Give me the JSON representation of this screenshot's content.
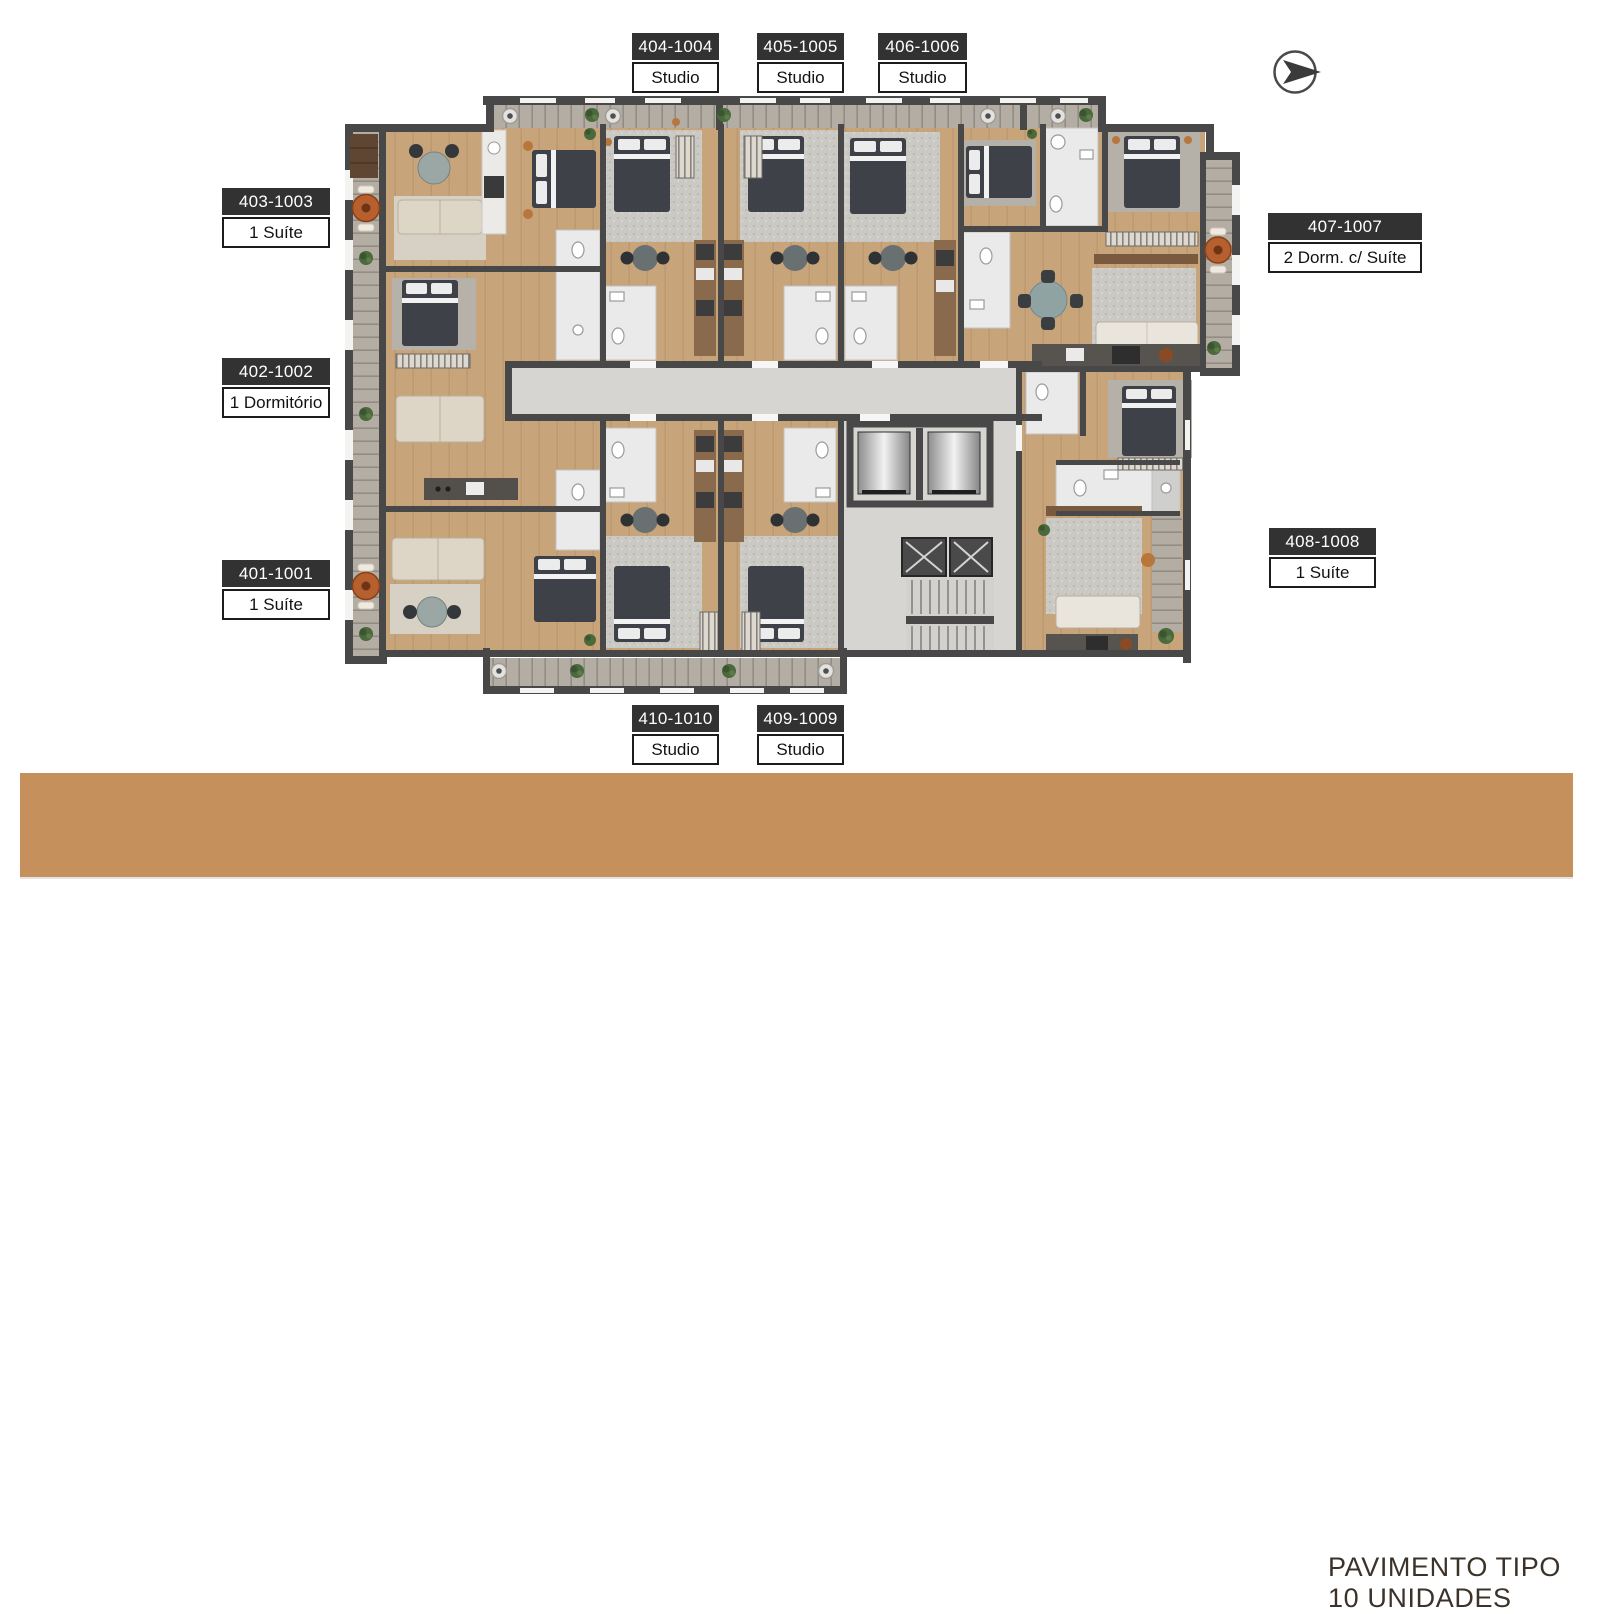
{
  "units": [
    {
      "id": "401-1001",
      "type": "1 Suíte",
      "side": "left"
    },
    {
      "id": "402-1002",
      "type": "1 Dormitório",
      "side": "left"
    },
    {
      "id": "403-1003",
      "type": "1 Suíte",
      "side": "left"
    },
    {
      "id": "404-1004",
      "type": "Studio",
      "side": "top"
    },
    {
      "id": "405-1005",
      "type": "Studio",
      "side": "top"
    },
    {
      "id": "406-1006",
      "type": "Studio",
      "side": "top"
    },
    {
      "id": "407-1007",
      "type": "2 Dorm. c/ Suíte",
      "side": "right"
    },
    {
      "id": "408-1008",
      "type": "1 Suíte",
      "side": "right"
    },
    {
      "id": "409-1009",
      "type": "Studio",
      "side": "bottom"
    },
    {
      "id": "410-1010",
      "type": "Studio",
      "side": "bottom"
    }
  ],
  "footer": {
    "line1": "PAVIMENTO TIPO",
    "line2": "10 UNIDADES"
  },
  "icons": {
    "north_arrow": "north-arrow"
  },
  "palette": {
    "footer_bar": "#c5905c",
    "footer_text": "#3b332a",
    "label_header_bg": "#323232",
    "label_header_text": "#ffffff",
    "label_body_bg": "#ffffff",
    "label_body_border": "#1c1c1c",
    "wall": "#484848",
    "wood_floor": "#c8a47b",
    "balcony_deck": "#b4ada3",
    "corridor_concrete": "#d6d5d2",
    "bathroom_tile": "#eaeaea",
    "rug_gray": "#a7a6a3",
    "bed_dark": "#3e4147",
    "sofa_beige": "#ddd5c6",
    "accent_terracotta": "#b65f2f",
    "plant_green": "#4a6a3c"
  }
}
